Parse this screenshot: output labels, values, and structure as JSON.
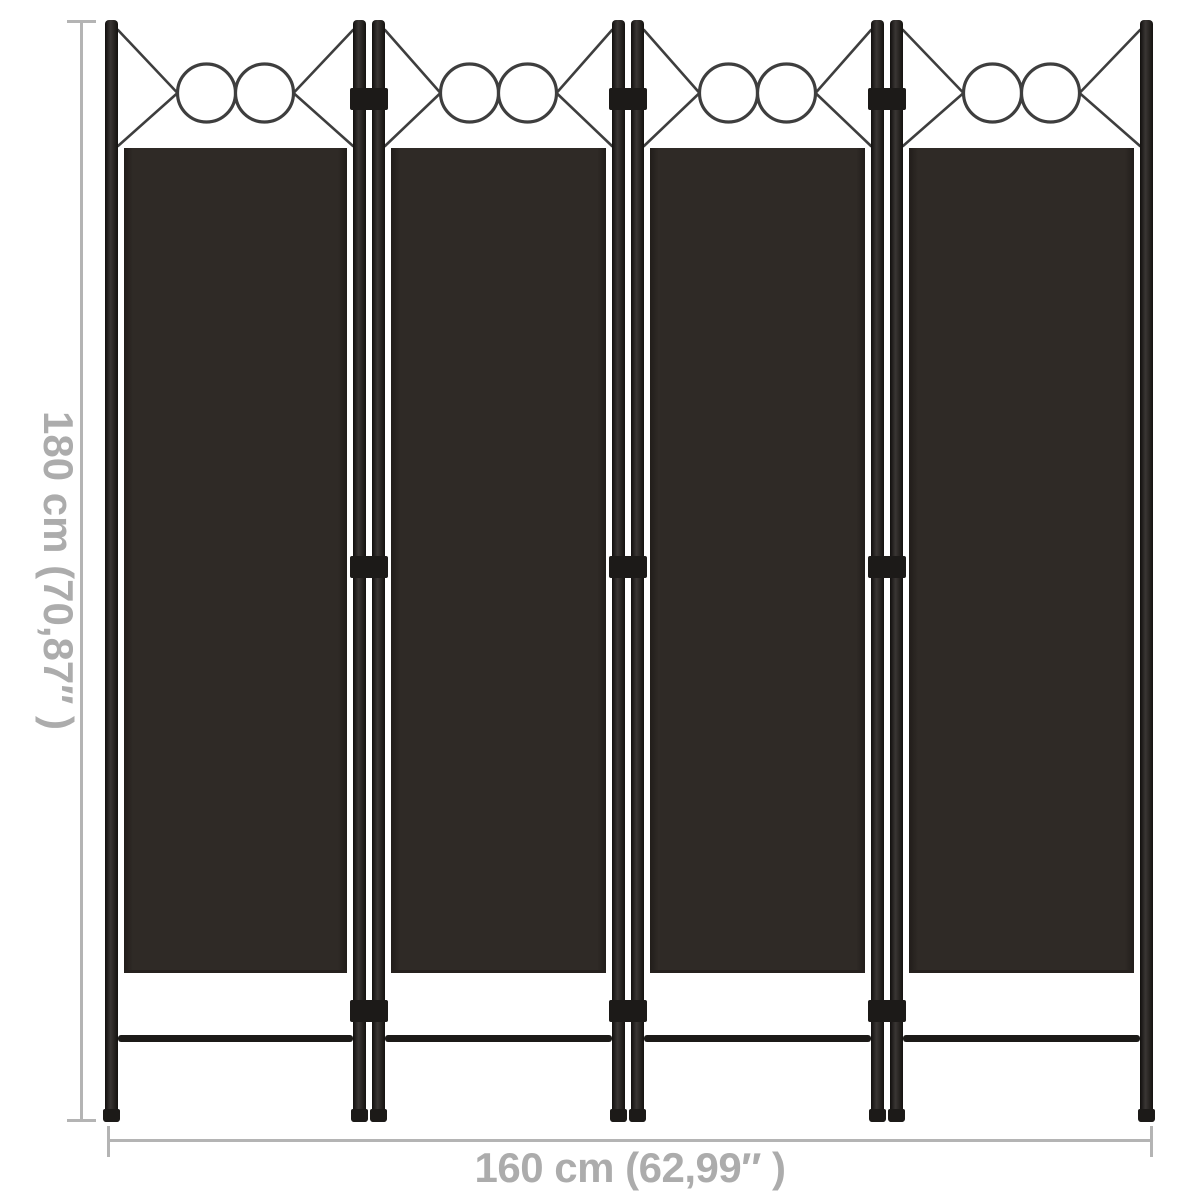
{
  "diagram": {
    "name": "4-panel room divider dimension diagram",
    "panel_count": 4,
    "ornament_circles_per_panel": 2,
    "hinge_rows": 3
  },
  "dimensions": {
    "height_label": "180 cm (70,87″ )",
    "width_label": "160 cm (62,99″ )"
  },
  "colors": {
    "background": "#ffffff",
    "fabric": "#2f2a26",
    "frame": "#1c1a18",
    "ornament": "#3e3e3e",
    "dim_line": "#b4b4b4",
    "dim_text": "#acacac"
  }
}
